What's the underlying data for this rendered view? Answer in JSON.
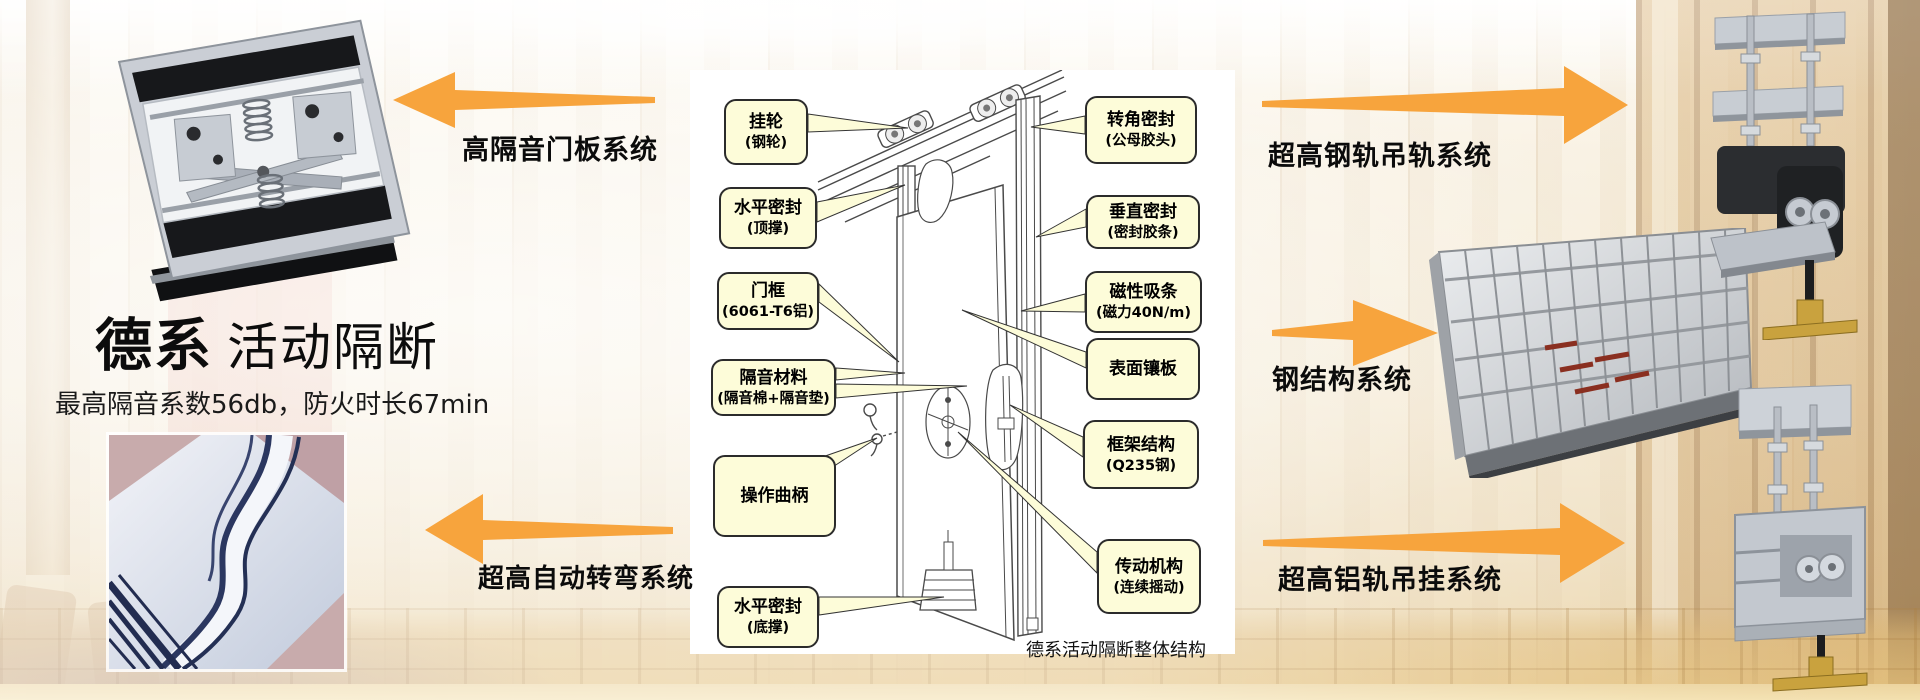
{
  "slide": {
    "title_bold": "德系",
    "title_regular": "活动隔断",
    "subtitle": "最高隔音系数56db，防火时长67min"
  },
  "system_labels": {
    "door_panel": "高隔音门板系统",
    "auto_turn": "超高自动转弯系统",
    "steel_rail": "超高钢轨吊轨系统",
    "steel_structure": "钢结构系统",
    "alu_rail": "超高铝轨吊挂系统"
  },
  "diagram": {
    "caption": "德系活动隔断整体结构",
    "callouts": {
      "hanging_wheel": {
        "line1": "挂轮",
        "line2": "(钢轮)"
      },
      "top_seal": {
        "line1": "水平密封",
        "line2": "(顶撑)"
      },
      "door_frame": {
        "line1": "门框",
        "line2": "(6061-T6铝)"
      },
      "acoustic_material": {
        "line1": "隔音材料",
        "line2": "(隔音棉+隔音垫)"
      },
      "crank": {
        "line1": "操作曲柄"
      },
      "bottom_seal": {
        "line1": "水平密封",
        "line2": "(底撑)"
      },
      "corner_seal": {
        "line1": "转角密封",
        "line2": "(公母胶头)"
      },
      "vertical_seal": {
        "line1": "垂直密封",
        "line2": "(密封胶条)"
      },
      "magnetic_strip": {
        "line1": "磁性吸条",
        "line2": "(磁力40N/m)"
      },
      "surface_panel": {
        "line1": "表面镶板"
      },
      "frame_structure": {
        "line1": "框架结构",
        "line2": "(Q235钢)"
      },
      "drive_mechanism": {
        "line1": "传动机构",
        "line2": "(连续摇动)"
      }
    }
  },
  "colors": {
    "arrow_orange": "#F7A43D",
    "callout_bg": "#FDFCD9",
    "callout_border": "#2B2B2B",
    "diagram_bg": "#FFFFFF",
    "label_text": "#0B0B0B"
  }
}
